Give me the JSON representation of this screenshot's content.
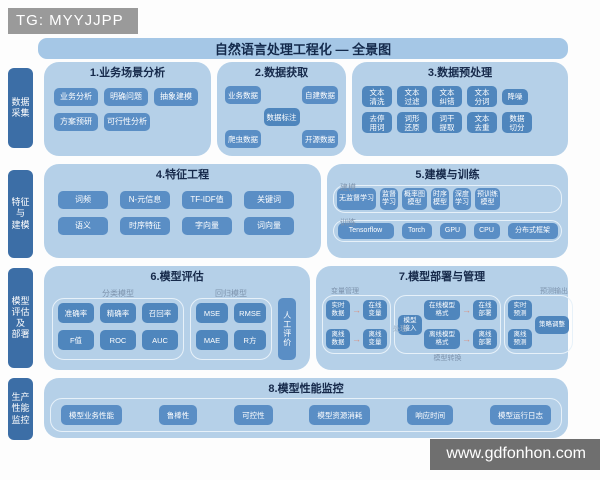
{
  "watermarks": {
    "top": "TG: MYYJJPP",
    "bottom": "www.gdfonhon.com"
  },
  "title": "自然语言处理工程化 — 全景图",
  "icons": {
    "arrow_right": "→"
  },
  "sidebar": {
    "items": [
      {
        "label": "数据\n采集"
      },
      {
        "label": "特征\n与\n建模"
      },
      {
        "label": "模型\n评估\n及\n部署"
      },
      {
        "label": "生产\n性能\n监控"
      }
    ]
  },
  "sections": {
    "s1": {
      "title": "1.业务场景分析",
      "row1": [
        "业务分析",
        "明确问题",
        "抽象建模"
      ],
      "row2": [
        "方案预研",
        "可行性分析"
      ]
    },
    "s2": {
      "title": "2.数据获取",
      "left": [
        "业务数据",
        "爬虫数据"
      ],
      "center": "数据标注",
      "right": [
        "自建数据",
        "开源数据"
      ]
    },
    "s3": {
      "title": "3.数据预处理",
      "row1": [
        "文本\n清洗",
        "文本\n过滤",
        "文本\n纠错",
        "文本\n分词",
        "降噪"
      ],
      "row2": [
        "去停\n用词",
        "词形\n还原",
        "词干\n提取",
        "文本\n去重",
        "数据\n切分"
      ]
    },
    "s4": {
      "title": "4.特征工程",
      "row1": [
        "词频",
        "N-元信息",
        "TF-IDF值",
        "关键词"
      ],
      "row2": [
        "语义",
        "时序特征",
        "字向量",
        "词向量"
      ]
    },
    "s5": {
      "title": "5.建模与训练",
      "tag1": "建模",
      "row1": [
        "无监督学习",
        "监督\n学习",
        "概率图\n模型",
        "时序\n模型",
        "深度\n学习",
        "预训练\n模型"
      ],
      "tag2": "训练",
      "row2": [
        "Tensorflow",
        "Torch",
        "GPU",
        "CPU",
        "分布式框架"
      ]
    },
    "s6": {
      "title": "6.模型评估",
      "group1_label": "分类模型",
      "g1row1": [
        "准确率",
        "精确率",
        "召回率"
      ],
      "g1row2": [
        "F值",
        "ROC",
        "AUC"
      ],
      "group2_label": "回归模型",
      "g2row1": [
        "MSE",
        "RMSE"
      ],
      "g2row2": [
        "MAE",
        "R方"
      ],
      "manual": "人工评价"
    },
    "s7": {
      "title": "7.模型部署与管理",
      "group1_label": "变量管理",
      "g1": {
        "r1a": "实时\n数据",
        "r1b": "在线\n变量",
        "r2a": "离线\n数据",
        "r2b": "离线\n变量"
      },
      "group2_label_left": "处理",
      "group2_label_bottom": "模型转换",
      "g2": {
        "input": "模型\n接入",
        "fmt_online": "在线模型\n格式",
        "deploy_online": "在线\n部署",
        "fmt_offline": "离线模型\n格式",
        "deploy_offline": "离线\n部署"
      },
      "group3_label": "预测输出",
      "g3": {
        "rt": "实时\n预测",
        "off": "离线\n预测",
        "adjust": "策略调整"
      }
    },
    "s8": {
      "title": "8.模型性能监控",
      "items": [
        "模型业务性能",
        "鲁棒性",
        "可控性",
        "模型资源消耗",
        "响应时间",
        "模型运行日志"
      ]
    }
  }
}
